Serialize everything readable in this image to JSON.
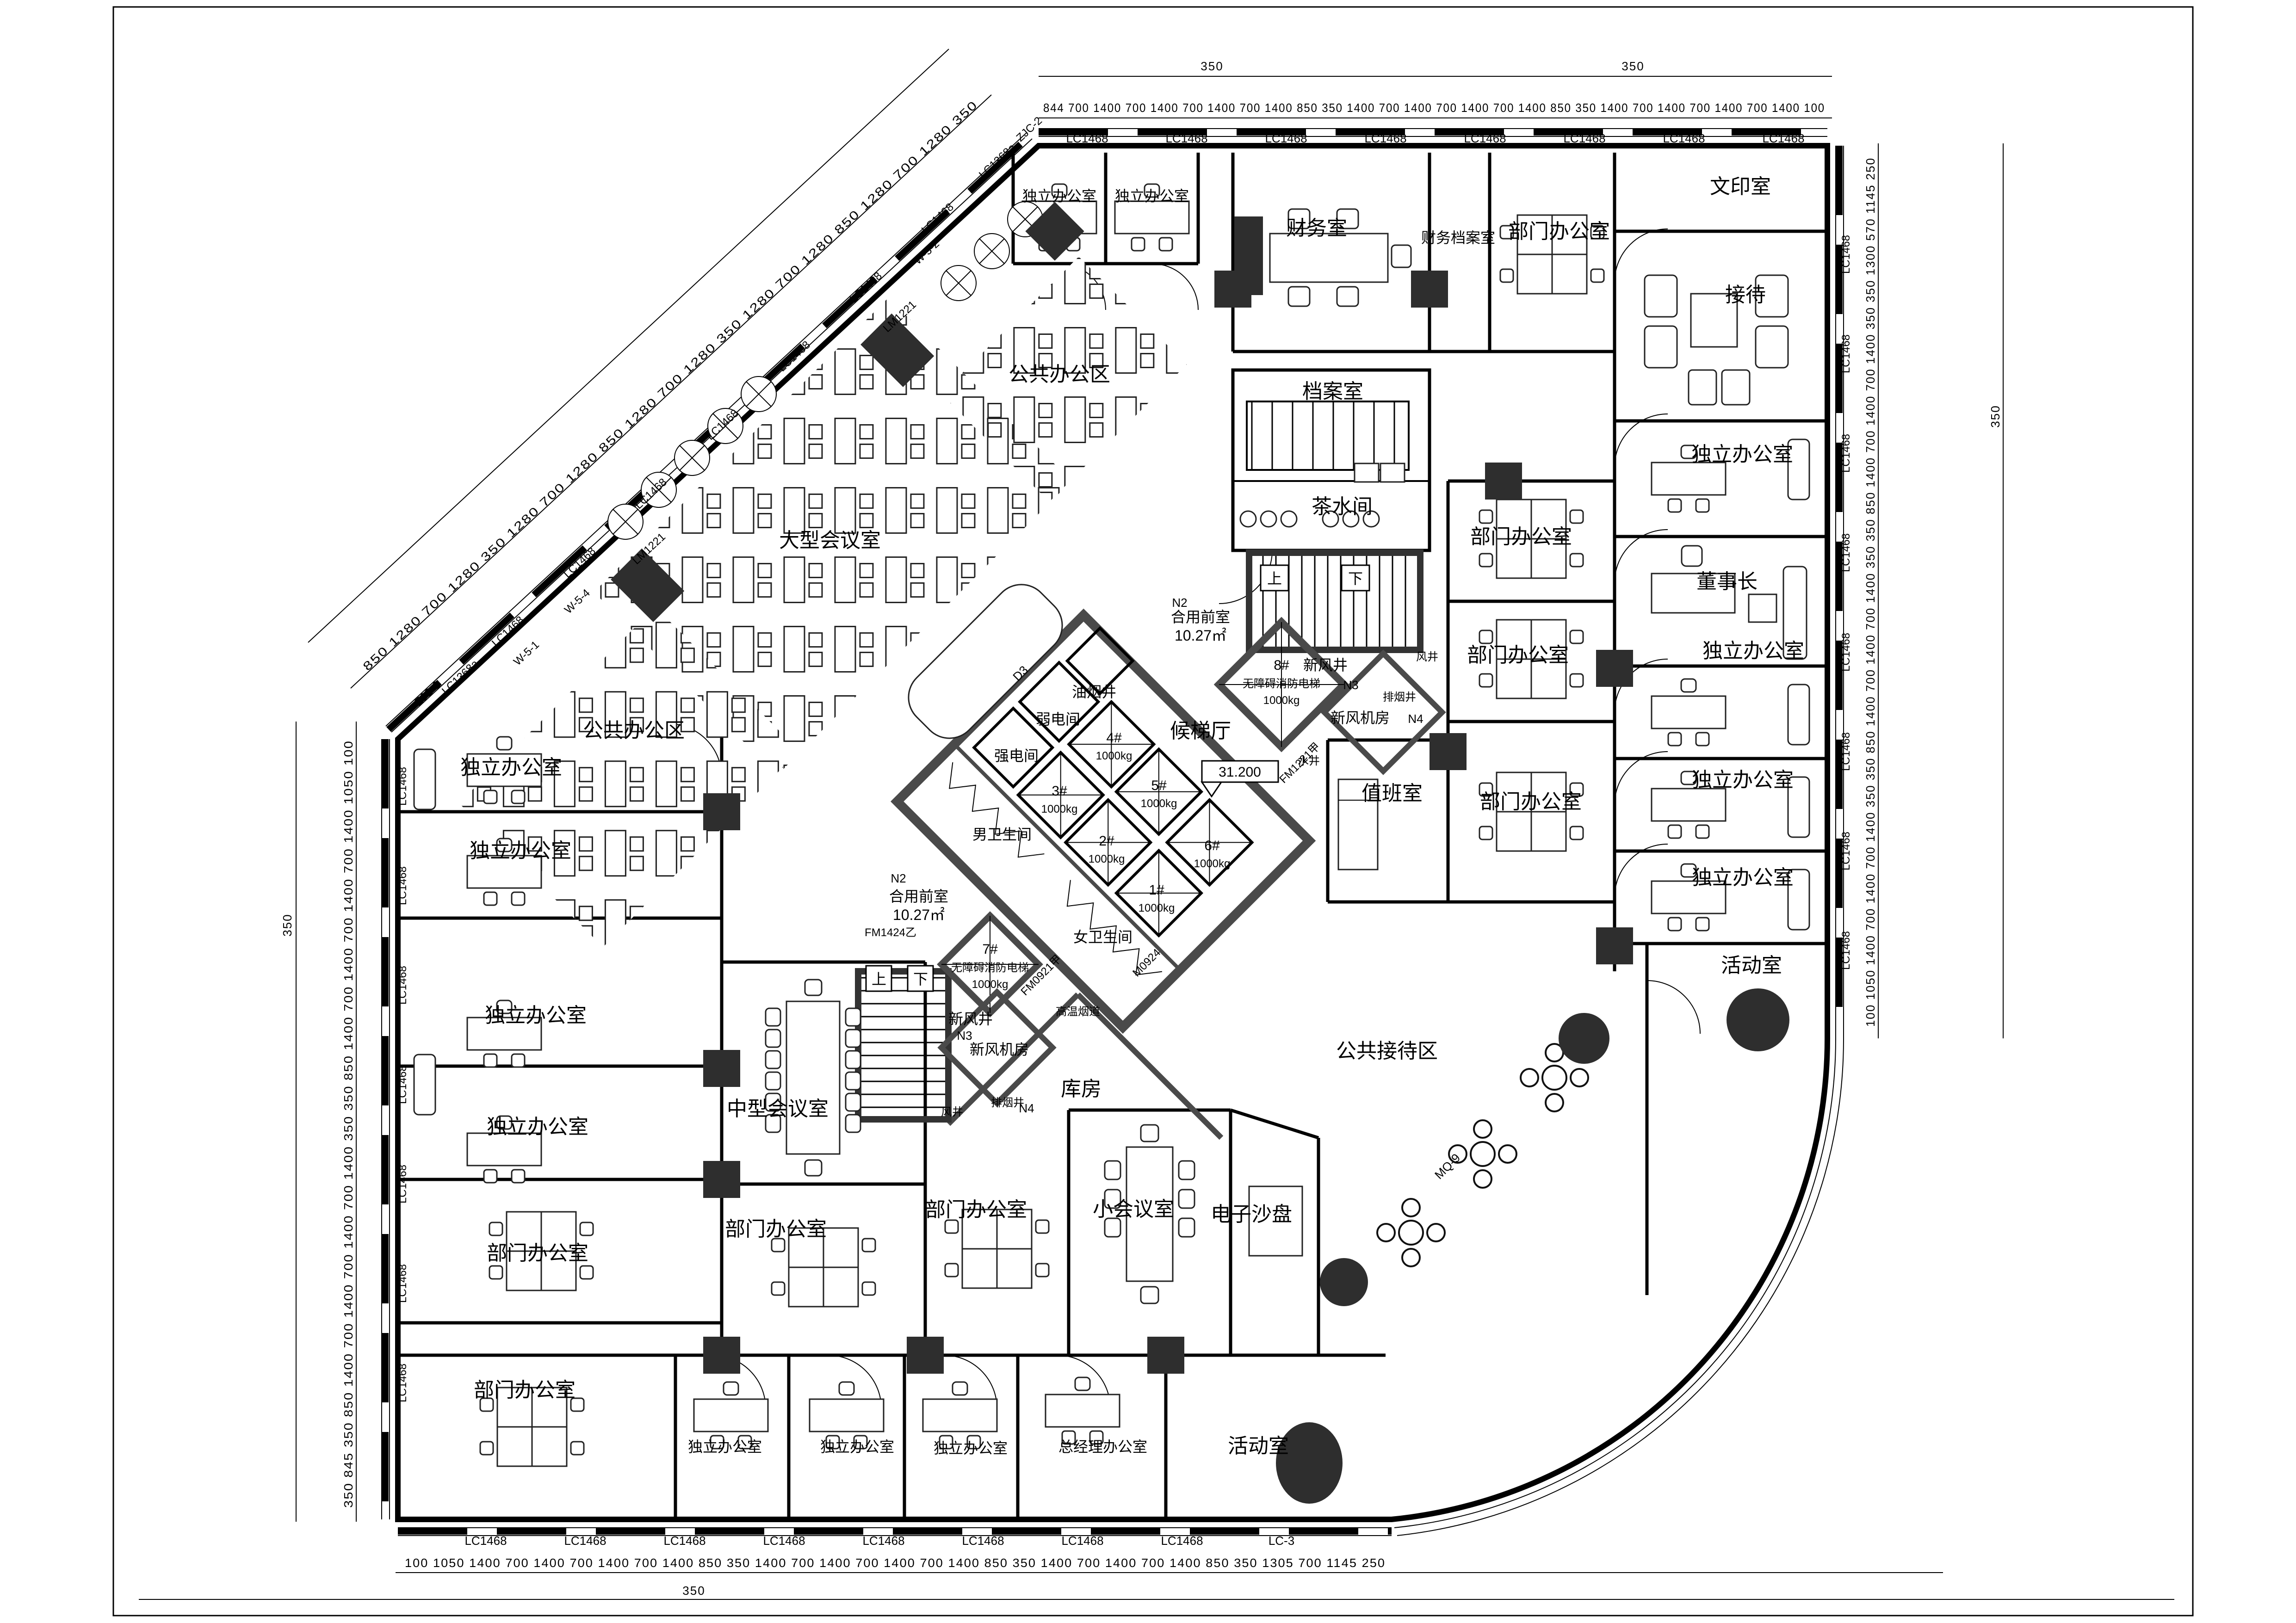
{
  "sheet": {
    "background": "#ffffff",
    "line_color": "#000000",
    "core_wall_color": "#4a4a4a",
    "column_color": "#2e2e2e"
  },
  "rooms": {
    "independent_office": "独立办公室",
    "department_office": "部门办公室",
    "public_office_area": "公共办公区",
    "finance_office": "财务室",
    "finance_archive": "财务档案室",
    "archive_room": "档案室",
    "print_room": "文印室",
    "reception": "接待",
    "tea_room": "茶水间",
    "chairman": "董事长",
    "activity_room": "活动室",
    "duty_room": "值班室",
    "large_meeting_room": "大型会议室",
    "medium_meeting_room": "中型会议室",
    "small_meeting_room": "小会议室",
    "gm_office": "总经理办公室",
    "e_sand_table": "电子沙盘",
    "storage_room": "库房",
    "public_reception_area": "公共接待区",
    "elevator_lobby": "候梯厅",
    "shared_front_room": "合用前室",
    "shared_front_area": "10.27㎡",
    "mens_toilet": "男卫生间",
    "womens_toilet": "女卫生间",
    "strong_elec_room": "强电间",
    "weak_elec_room": "弱电间",
    "oil_smoke_shaft": "油烟井",
    "fresh_air_shaft": "新风井",
    "fresh_air_plant": "新风机房",
    "smoke_exhaust_shaft": "排烟井",
    "air_shaft": "风井",
    "water_shaft": "水井",
    "high_temp_flue": "高温烟道",
    "up": "上",
    "down": "下"
  },
  "elevators": {
    "e1": "1#",
    "e2": "2#",
    "e3": "3#",
    "e4": "4#",
    "e5": "5#",
    "e6": "6#",
    "e7": "7#",
    "e8": "8#",
    "load": "1000kg",
    "fire_elevator": "无障碍消防电梯"
  },
  "tags": {
    "window": "LC1468",
    "window_a": "LC1368a",
    "window_b": "LC-3",
    "corner_2": "ZJC-2",
    "corner_3": "ZJC-3",
    "door": "LM1221",
    "fire_door_1": "FM1424乙",
    "fire_door_2": "FM0921甲",
    "fire_door_3": "FM1221甲",
    "door_m": "M0924",
    "curtain_wall": "MQ-9",
    "w51": "W-5-1",
    "w52": "W-5-2",
    "w54": "W-5-4",
    "n2": "N2",
    "n3": "N3",
    "n4": "N4",
    "d3": "D3"
  },
  "elevation": "31.200",
  "dims": {
    "top": "844 700 1400 700 1400 700 1400 700 1400 850 350 1400 700 1400 700 1400 700 1400 850 350 1400 700 1400 700 1400 700 1400 100",
    "bottom": "100 1050 1400 700 1400 700 1400 700 1400 850 350 1400 700 1400 700 1400 700 1400 850 350 1400 700 1400 700 1400 850 350 1305 700 1145 250",
    "left": "350 845 350 850 1400 700 1400 700 1400 700 1400 350 350 850 1400 700 1400 700 1400 700 1400 1050 100",
    "right": "100 1050 1400 700 1400 700 1400 350 350 850 1400 700 1400 700 1400 350 350 850 1400 700 1400 700 1400 350 350 1300 570 1145 250",
    "diagonal": "850 1280 700 1280 350 1280 700 1280 850 1280 700 1280 350 1280 700 1280 850 1280 700 1280 350",
    "sep": "350"
  }
}
